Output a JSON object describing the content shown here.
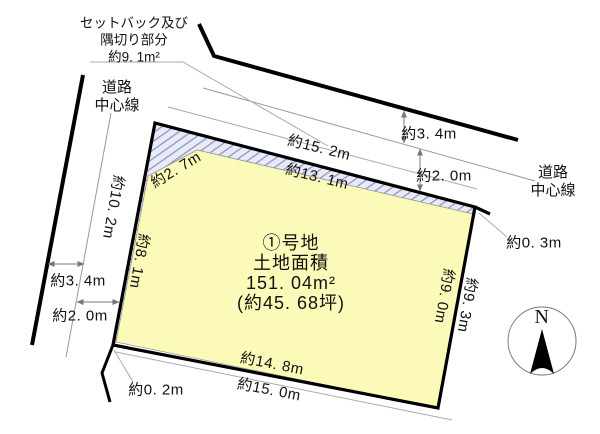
{
  "setback_note": [
    "セットバック及び",
    "隅切り部分",
    "約9. 1m²"
  ],
  "road_center_left": [
    "道路",
    "中心線"
  ],
  "road_center_right": [
    "道路",
    "中心線"
  ],
  "parcel_info": [
    "①号地",
    "土地面積",
    "151. 04m²",
    "(約45. 68坪)"
  ],
  "dimensions": {
    "top_outer": "約15. 2m",
    "top_inner": "約13. 1m",
    "top_road_to_center": "約3. 4m",
    "top_center_to_parcel": "約2. 0m",
    "corner_top_right": "約0. 3m",
    "right_inner": "約9. 0m",
    "right_outer": "約9. 3m",
    "bottom_inner": "約14. 8m",
    "bottom_outer": "約15. 0m",
    "corner_bottom_left": "約0. 2m",
    "left_road_to_center": "約3. 4m",
    "left_center_to_parcel": "約2. 0m",
    "corner_cut": "約2. 7m",
    "left_inner": "約8. 1m",
    "left_center": "約10. 2m"
  },
  "compass": {
    "north": "N"
  },
  "colors": {
    "parcel_fill": "#fcfab8",
    "hatch_stripe": "#8890c0",
    "hatch_bg": "#e8eaf5",
    "outline": "#000000",
    "thin_line": "#999999"
  }
}
